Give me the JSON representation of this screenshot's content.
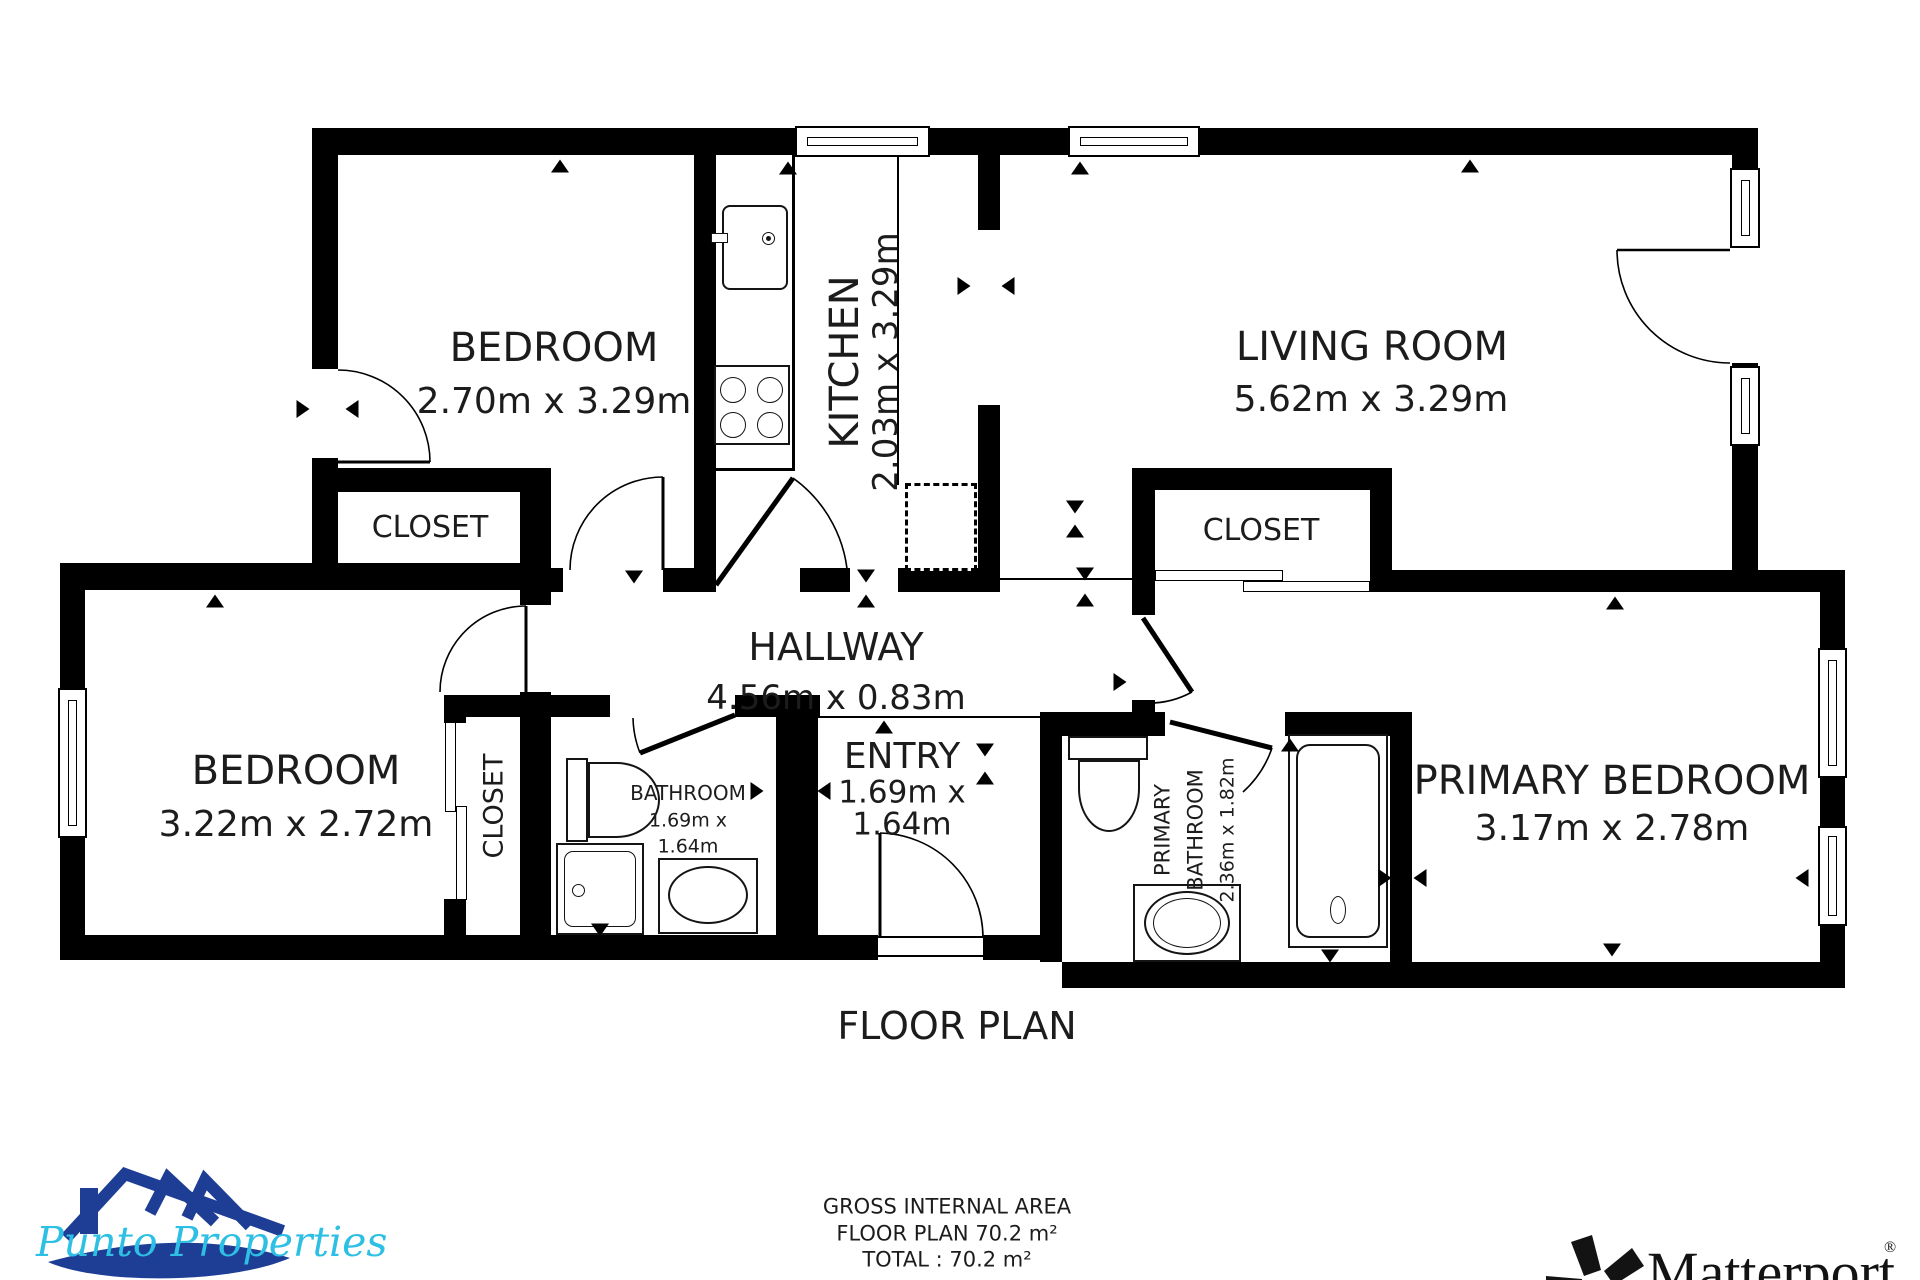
{
  "title": "FLOOR PLAN",
  "rooms": {
    "bedroom_top": {
      "name": "BEDROOM",
      "dims": "2.70m x 3.29m"
    },
    "kitchen": {
      "name": "KITCHEN",
      "dims": "2.03m x 3.29m"
    },
    "living_room": {
      "name": "LIVING ROOM",
      "dims": "5.62m x 3.29m"
    },
    "closet_top": {
      "name": "CLOSET"
    },
    "closet_right": {
      "name": "CLOSET"
    },
    "bedroom_left": {
      "name": "BEDROOM",
      "dims": "3.22m x 2.72m"
    },
    "closet_small": {
      "name": "CLOSET"
    },
    "bathroom": {
      "name": "BATHROOM",
      "dims_line1": "1.69m x",
      "dims_line2": "1.64m"
    },
    "hallway": {
      "name": "HALLWAY",
      "dims": "4.56m x 0.83m"
    },
    "entry": {
      "name": "ENTRY",
      "dims_line1": "1.69m x",
      "dims_line2": "1.64m"
    },
    "primary_bathroom": {
      "name_line1": "PRIMARY",
      "name_line2": "BATHROOM",
      "dims": "2.36m x 1.82m"
    },
    "primary_bedroom": {
      "name": "PRIMARY BEDROOM",
      "dims": "3.17m x 2.78m"
    }
  },
  "footer": {
    "line1": "GROSS INTERNAL AREA",
    "line2": "FLOOR PLAN 70.2 m²",
    "line3": "TOTAL :  70.2 m²"
  },
  "branding": {
    "agency": "Punto Properties",
    "provider": "Matterport",
    "registered": "®",
    "colors": {
      "wall": "#000000",
      "agency_navy": "#1e3e96",
      "agency_cyan": "#2ebfe4",
      "provider_black": "#131313"
    }
  }
}
